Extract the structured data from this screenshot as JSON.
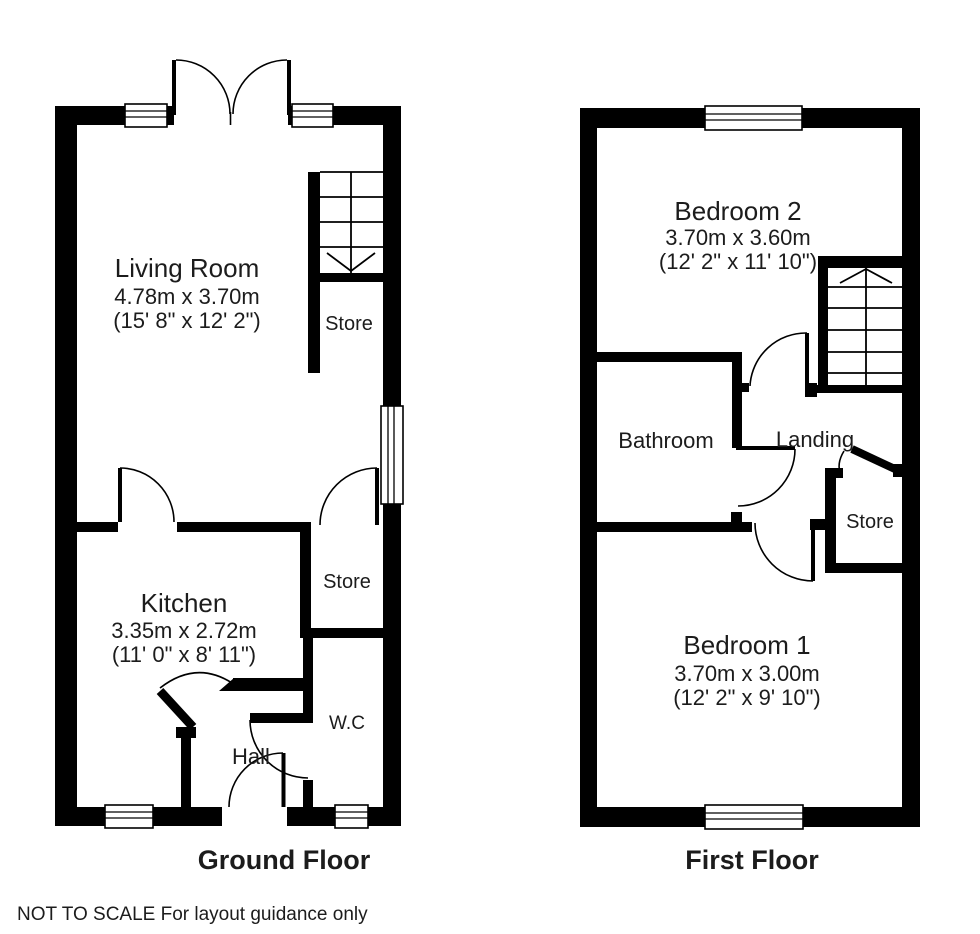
{
  "colors": {
    "wall": "#000000",
    "floor_title": "#2b5244",
    "text": "#1c1c1c"
  },
  "footnote": "NOT TO SCALE For layout guidance only",
  "ground_floor": {
    "title": "Ground Floor",
    "living_room": {
      "name": "Living Room",
      "dim_metric": "4.78m x 3.70m",
      "dim_imperial": "(15' 8\" x 12' 2\")"
    },
    "kitchen": {
      "name": "Kitchen",
      "dim_metric": "3.35m x 2.72m",
      "dim_imperial": "(11' 0\" x 8' 11\")"
    },
    "store_under_stairs": {
      "name": "Store"
    },
    "store": {
      "name": "Store"
    },
    "wc": {
      "name": "W.C"
    },
    "hall": {
      "name": "Hall"
    }
  },
  "first_floor": {
    "title": "First Floor",
    "bedroom2": {
      "name": "Bedroom 2",
      "dim_metric": "3.70m x 3.60m",
      "dim_imperial": "(12' 2\" x 11' 10\")"
    },
    "bedroom1": {
      "name": "Bedroom 1",
      "dim_metric": "3.70m x 3.00m",
      "dim_imperial": "(12' 2\" x 9' 10\")"
    },
    "bathroom": {
      "name": "Bathroom"
    },
    "landing": {
      "name": "Landing"
    },
    "store": {
      "name": "Store"
    }
  }
}
